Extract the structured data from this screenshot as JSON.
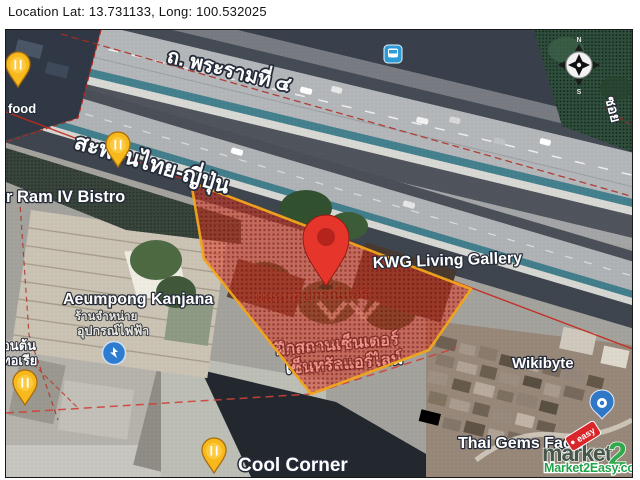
{
  "header": {
    "location_label": "Location Lat: 13.731133, Long: 100.532025"
  },
  "map": {
    "labels": {
      "road": "ถ. พระรามที่ ๔",
      "bridge": "สะพานไทย-ญี่ปุ่น",
      "soi": "ซอย",
      "food_partial": "food",
      "bistro": "r Ram IV Bistro",
      "aeumpong": "Aeumpong Kanjana",
      "aeumpong_sub1": "ร้านจำหน่าย",
      "aeumpong_sub2": "อุปกรณ์ไฟฟ้า",
      "parcel_inline": "แผนกอุปกรณ์แอร์",
      "kwg": "KWG Living Gallery",
      "parcel_line1": "ฝึกสถานเซ็นเตอร์",
      "parcel_line2": "เซ็นทรัลแอร์ไลน์",
      "wikibyte": "Wikibyte",
      "thai_gems": "Thai Gems Facto",
      "cool_corner": "Cool Corner",
      "left_edge_line1": "อนต้น",
      "left_edge_line2": "ทอเรีย"
    },
    "compass": {
      "north": "N",
      "south": "S"
    },
    "highlight": {
      "fill_color": "#e23a24",
      "border_color": "#f2a61c"
    },
    "marker_color": "#e6352b",
    "icons": {
      "property_marker": "red-location-pin",
      "restaurant_pins": "restaurant-pin",
      "bus_stop": "bus-stop-icon",
      "electrical_shop": "electrical-shop-icon",
      "place_pin": "place-shield-pin",
      "compass": "compass-rose-icon"
    }
  },
  "watermark": {
    "brand": "market",
    "brand_suffix": "2",
    "tag": "easy",
    "site": "Market2Easy.com",
    "green": "#2fa84e",
    "red": "#d8262a"
  }
}
